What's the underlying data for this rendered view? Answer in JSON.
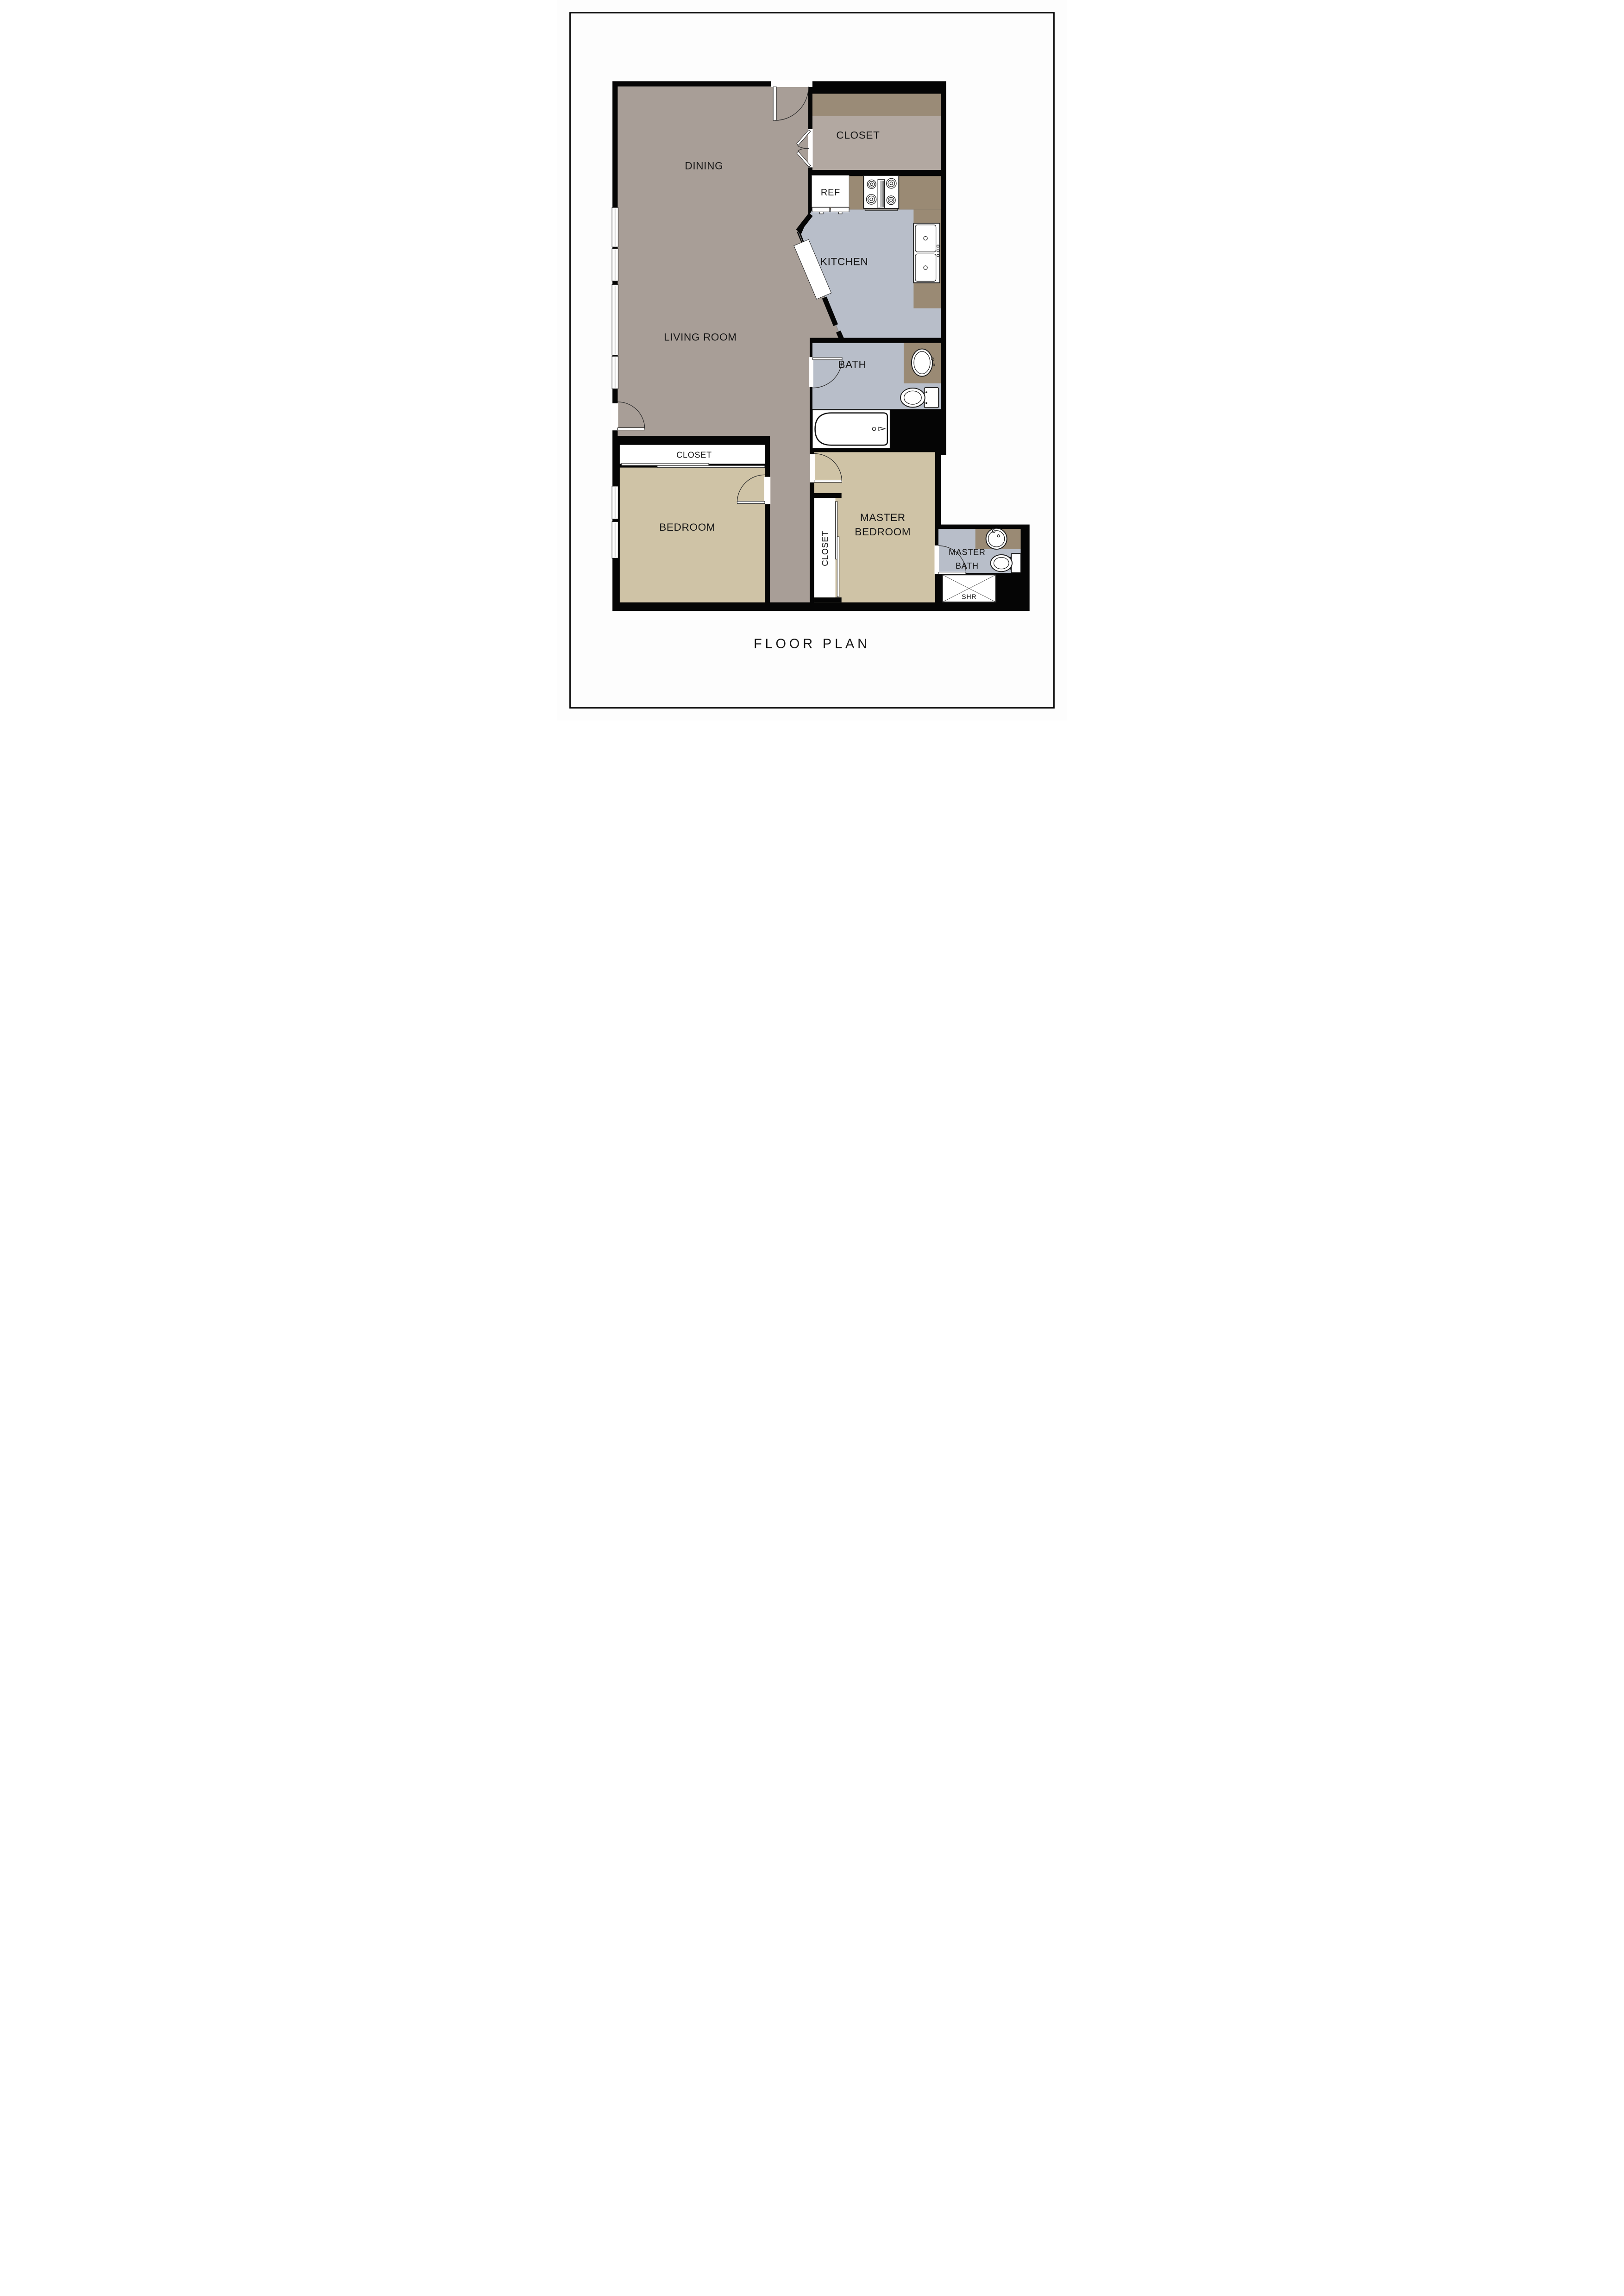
{
  "title": "FLOOR PLAN",
  "colors": {
    "page-bg": "#fdfdfd",
    "wall": "#050505",
    "floor-living": "#a89e97",
    "floor-closet": "#b2a8a1",
    "closet-shelf": "#9a8b77",
    "floor-kitchen": "#b8bec9",
    "counter": "#9a8a74",
    "floor-bedroom": "#cfc3a6",
    "ink": "#161616"
  },
  "rooms": {
    "dining": {
      "label": "DINING"
    },
    "closet_top": {
      "label": "CLOSET"
    },
    "kitchen": {
      "label": "KITCHEN"
    },
    "living": {
      "label": "LIVING ROOM"
    },
    "bath": {
      "label": "BATH"
    },
    "bedroom_closet": {
      "label": "CLOSET"
    },
    "bedroom": {
      "label": "BEDROOM"
    },
    "master_bedroom": {
      "line1": "MASTER",
      "line2": "BEDROOM"
    },
    "master_closet": {
      "label": "CLOSET"
    },
    "master_bath": {
      "line1": "MASTER",
      "line2": "BATH"
    }
  },
  "fixtures": {
    "refrigerator": {
      "label": "REF"
    },
    "shower": {
      "label": "SHR"
    }
  }
}
